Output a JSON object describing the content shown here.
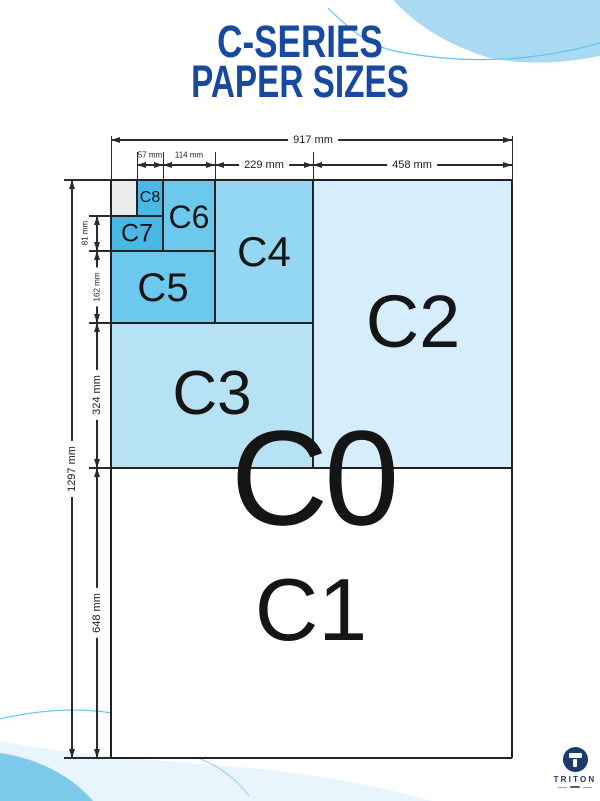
{
  "title": {
    "line1": "C-SERIES",
    "line2": "PAPER SIZES"
  },
  "paper_sizes": {
    "c0": "C0",
    "c1": "C1",
    "c2": "C2",
    "c3": "C3",
    "c4": "C4",
    "c5": "C5",
    "c6": "C6",
    "c7": "C7",
    "c8": "C8"
  },
  "dimensions": {
    "width_total": "917 mm",
    "width_c2": "458 mm",
    "width_c4": "229 mm",
    "width_c6": "114 mm",
    "width_c8": "57 mm",
    "height_total": "1297 mm",
    "height_c1": "648 mm",
    "height_c3": "324 mm",
    "height_c5": "162 mm",
    "height_c7": "81 mm"
  },
  "colors": {
    "c2": "#d6eefb",
    "c3": "#b7e2f5",
    "c4": "#93d7f2",
    "c5": "#6cc8ec",
    "c6": "#6cc8ec",
    "c7": "#49b8e5",
    "c8": "#49b8e5",
    "unlabeled": "#ebebee",
    "title_text": "#17499e",
    "outline": "#222222",
    "accent_curve": "#5ec5e9",
    "blob_top_right": "#a9daf2",
    "blob_bottom_pale": "#e9f5fc",
    "blob_bottom_corner": "#7ecaed",
    "logo_navy": "#1d3a6b"
  },
  "logo": {
    "brand": "TRITON"
  }
}
